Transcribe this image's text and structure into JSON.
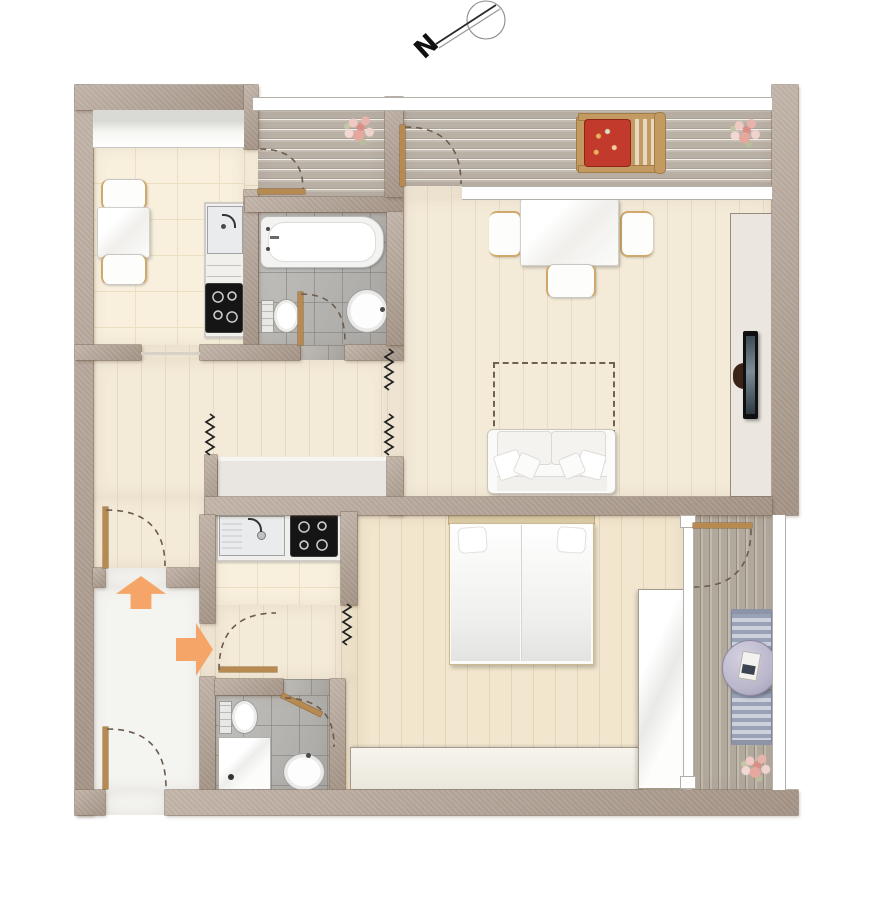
{
  "compass": {
    "label": "N"
  },
  "colors": {
    "wall": "#b2a092",
    "wallEdge": "#8f7e6e",
    "floorTile": "#f8f0dd",
    "tileLine": "#ecdfc4",
    "floorWood": "#f4ead8",
    "floorBedroom": "#f2e6cf",
    "floorEntry": "#f4f4f1",
    "bathTile": "#b2b0ac",
    "deck": "#beb5ab",
    "deckLight": "#c6beb4",
    "balconyDeck": "#b7aea2",
    "balconyDeckDark": "#968d81",
    "windowWhite": "#ffffff",
    "windowFrame": "#b3b0aa",
    "arrowOrange": "#f5a567",
    "arrowEdge": "#b5763a",
    "doorLeaf": "#b68a50",
    "swingDash": "#6b5c4e",
    "cooktopBlack": "#151515",
    "cushionRed": "#c23a2c",
    "loungerWood": "#c39a62",
    "stripeBlue": "#98a2b7",
    "stripeLight": "#ccd1db",
    "tableLavender": "#bbb7cc",
    "tvPanel": "#ebe7e0",
    "closetFill": "#e9e6e1",
    "heater": "#222222"
  },
  "rooms": [
    "kitchen-dining",
    "bathroom-upper",
    "hallway-upper",
    "living-room",
    "terrace",
    "stairwell-entry",
    "kitchenette-lower",
    "hallway-lower",
    "bathroom-lower",
    "bedroom",
    "balcony"
  ],
  "furniture": [
    "dining-table-small",
    "dining-chairs",
    "kitchenette-sink",
    "cooktop",
    "bathtub",
    "toilet",
    "washbasin",
    "wall-closet",
    "dining-table",
    "dining-chairs-living",
    "sofa",
    "sofa-pillows",
    "planned-table-outline",
    "tv-sideboard",
    "wall-tv",
    "double-bed",
    "bed-pillows",
    "sideboard",
    "wardrobe",
    "shower",
    "sun-lounger-with-red-cushion",
    "flower-pots",
    "striped-deck-chairs",
    "round-balcony-table",
    "magazine"
  ],
  "symbols": [
    "north-compass",
    "entry-arrow-up",
    "entry-arrow-right",
    "door-swing-arcs",
    "heater-zigzag-symbols",
    "terrace-railing",
    "balcony-railing"
  ]
}
